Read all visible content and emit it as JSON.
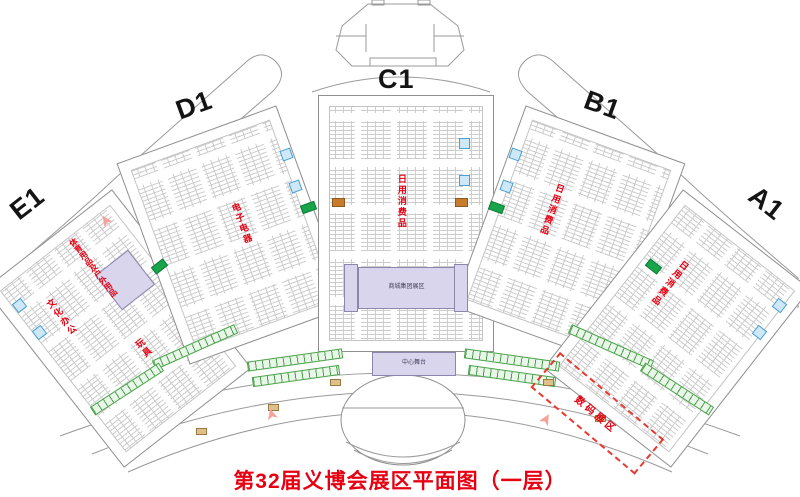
{
  "title": "第32届义博会展区平面图（一层）",
  "halls": {
    "a1": {
      "label": "A1",
      "category": "日用消费品"
    },
    "b1": {
      "label": "B1",
      "category": "日用消费品"
    },
    "c1": {
      "label": "C1",
      "category": "日用消费品"
    },
    "d1": {
      "label": "D1",
      "category": "电子电器"
    },
    "e1": {
      "label": "E1",
      "categories": {
        "sport": "体育用品及户外用品",
        "culture": "文化办公",
        "toys": "玩具"
      }
    }
  },
  "areas": {
    "central_exhibit": "商城集团展区",
    "stage": "中心舞台",
    "dashed_zone": "数码展区"
  },
  "icons": {
    "entrance_arrow": "➤"
  },
  "colors": {
    "title_red": "#e60012",
    "label_red": "#e60012",
    "hall_outline": "#8f8f8f",
    "booth_line": "#cdcdcd",
    "purple_area": "#d9d5ec",
    "green_accent": "#4aa34a",
    "solid_green": "#18a44a",
    "blue_marker": "#4a9fd4",
    "orange_marker": "#c97b2d",
    "entrance_pink": "#f4a39b"
  }
}
